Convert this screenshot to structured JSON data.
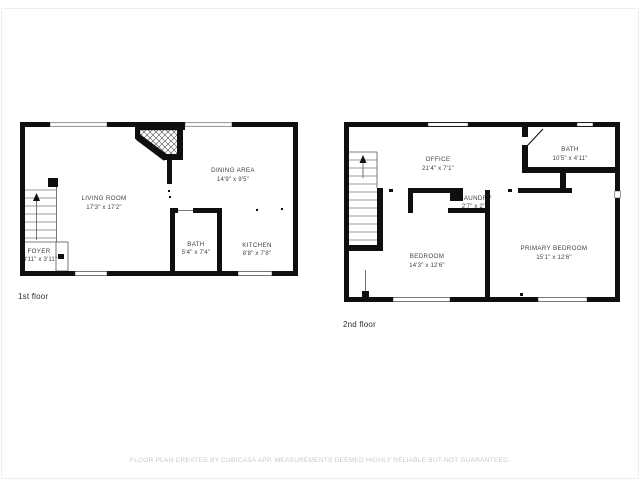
{
  "page": {
    "background": "#ffffff",
    "border_color": "#eeeeee"
  },
  "colors": {
    "wall": "#0f0f0f",
    "room_text": "#3f3f3f",
    "floor_label_text": "#303030",
    "disclaimer_text": "#c9c9c9"
  },
  "floors": [
    {
      "label": "1st floor",
      "rooms": [
        {
          "name": "LIVING ROOM",
          "dims": "17'3\" x 17'2\""
        },
        {
          "name": "DINING AREA",
          "dims": "14'9\" x 9'5\""
        },
        {
          "name": "BATH",
          "dims": "5'4\" x 7'4\""
        },
        {
          "name": "KITCHEN",
          "dims": "8'8\" x 7'8\""
        },
        {
          "name": "FOYER",
          "dims": "3'11\" x 3'11\""
        }
      ]
    },
    {
      "label": "2nd floor",
      "rooms": [
        {
          "name": "OFFICE",
          "dims": "21'4\" x 7'1\""
        },
        {
          "name": "BATH",
          "dims": "10'5\" x 4'11\""
        },
        {
          "name": "LAUNDRY",
          "dims": "2'7\" x 2'7\""
        },
        {
          "name": "BEDROOM",
          "dims": "14'3\" x 12'6\""
        },
        {
          "name": "PRIMARY BEDROOM",
          "dims": "15'1\" x 12'6\""
        }
      ]
    }
  ],
  "footer": {
    "disclaimer": "FLOOR PLAN CREATED BY CUBICASA APP. MEASUREMENTS DEEMED HIGHLY RELIABLE BUT NOT GUARANTEED."
  }
}
